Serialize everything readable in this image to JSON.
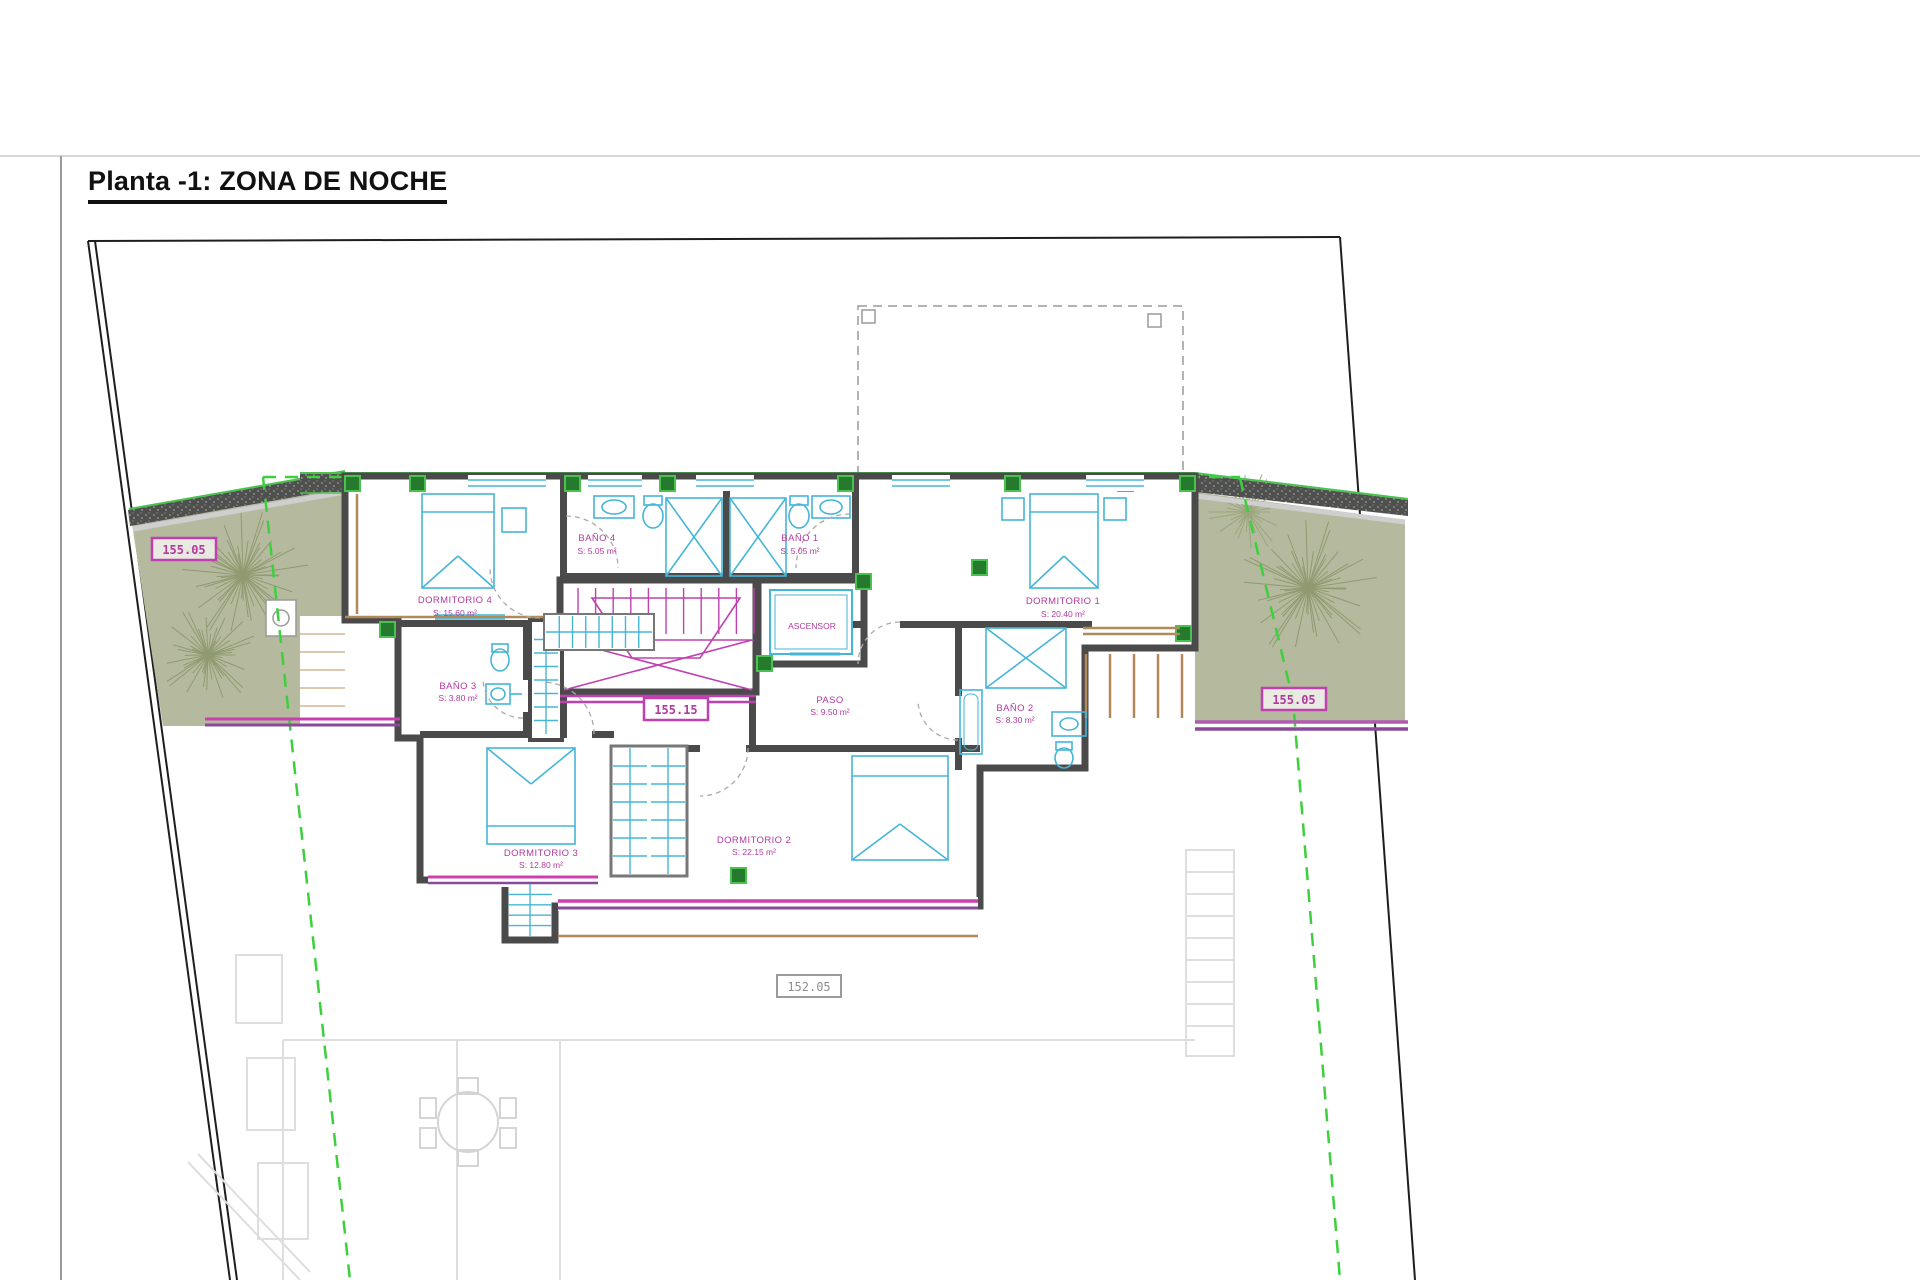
{
  "page": {
    "title": "Planta -1: ZONA DE NOCHE"
  },
  "rooms": {
    "bano4": {
      "name": "BAÑO 4",
      "area": "S: 5.05 m²"
    },
    "bano1": {
      "name": "BAÑO 1",
      "area": "S: 5.05 m²"
    },
    "dormitorio4": {
      "name": "DORMITORIO 4",
      "area": "S: 15.60 m²"
    },
    "dormitorio1": {
      "name": "DORMITORIO 1",
      "area": "S: 20.40 m²"
    },
    "ascensor": {
      "name": "ASCENSOR"
    },
    "bano3": {
      "name": "BAÑO 3",
      "area": "S: 3.80 m²"
    },
    "paso": {
      "name": "PASO",
      "area": "S: 9.50 m²"
    },
    "bano2": {
      "name": "BAÑO 2",
      "area": "S: 8.30 m²"
    },
    "dormitorio3": {
      "name": "DORMITORIO 3",
      "area": "S: 12.80 m²"
    },
    "dormitorio2": {
      "name": "DORMITORIO 2",
      "area": "S: 22.15 m²"
    }
  },
  "levels": {
    "terrace_left": "155.05",
    "terrace_right": "155.05",
    "stair_landing": "155.15",
    "lower_floor": "152.05"
  },
  "colors": {
    "label_magenta": "#b13a9e",
    "fixture_cyan": "#45b6d8",
    "wall_gray": "#4f4f4f",
    "terrace_green": "#b5ba9f",
    "setback_green": "#3ecf3e",
    "window_purple": "#8a4a9a",
    "window_magenta": "#cc3fb0"
  }
}
